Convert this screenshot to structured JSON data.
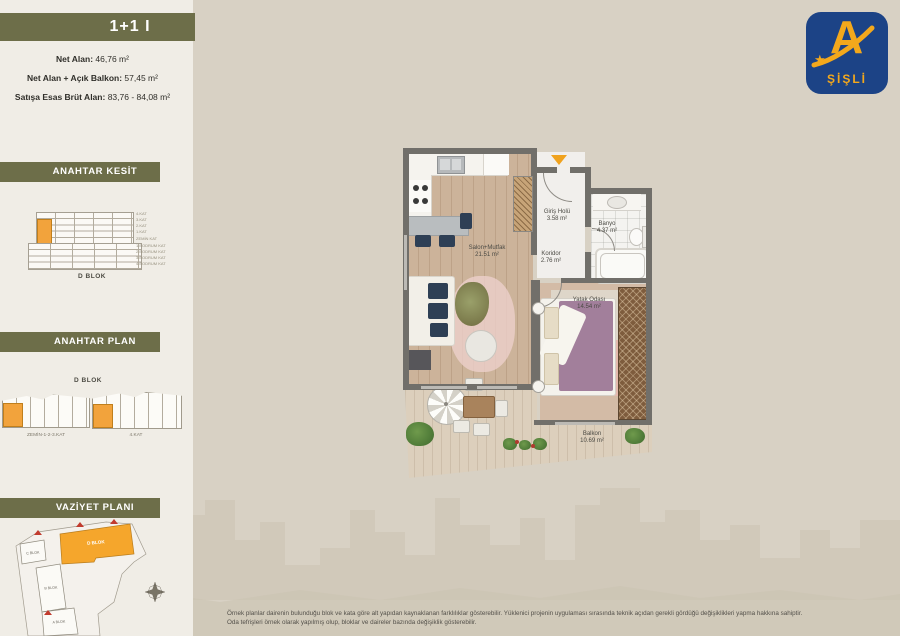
{
  "unit": {
    "title": "1+1 I",
    "areas": [
      {
        "label": "Net Alan:",
        "value": "46,76 m²"
      },
      {
        "label": "Net Alan + Açık Balkon:",
        "value": "57,45 m²"
      },
      {
        "label": "Satışa Esas Brüt Alan:",
        "value": "83,76 - 84,08 m²"
      }
    ]
  },
  "sidebar": {
    "kesit": {
      "title": "ANAHTAR KESİT",
      "caption": "D BLOK",
      "floors": [
        "4.KAT",
        "3.KAT",
        "2.KAT",
        "1.KAT",
        "ZEMİN KAT",
        "1.BODRUM KAT",
        "2.BODRUM KAT",
        "3.BODRUM KAT",
        "4.BODRUM KAT"
      ]
    },
    "plan": {
      "title": "ANAHTAR PLAN",
      "caption": "D BLOK",
      "variants": [
        {
          "label": "ZEMİN-1-2-3.KAT"
        },
        {
          "label": "4.KAT"
        }
      ]
    },
    "vaziyet": {
      "title": "VAZİYET PLANI",
      "blocks": [
        "C BLOK",
        "D BLOK",
        "B BLOK",
        "A BLOK"
      ],
      "highlighted_block": "D BLOK"
    }
  },
  "floorplan": {
    "rooms": [
      {
        "name": "Salon+Mutfak",
        "area": "21.51 m²"
      },
      {
        "name": "Giriş Holü",
        "area": "3.58 m²"
      },
      {
        "name": "Banyo",
        "area": "4.37 m²"
      },
      {
        "name": "Koridor",
        "area": "2.76 m²"
      },
      {
        "name": "Yatak Odası",
        "area": "14.54 m²"
      },
      {
        "name": "Balkon",
        "area": "10.69 m²"
      }
    ]
  },
  "logo": {
    "letter": "A",
    "star": "★",
    "name": "ŞİŞLİ"
  },
  "footer": {
    "line1": "Örnek planlar dairenin bulunduğu blok ve kata göre alt yapıdan kaynaklanan farklılıklar gösterebilir. Yüklenici projenin uygulaması sırasında teknik açıdan gerekli gördüğü değişiklikleri yapma hakkına sahiptir.",
    "line2": "Oda tefrişleri örnek olarak yapılmış olup, bloklar ve daireler bazında değişiklik gösterebilir."
  },
  "colors": {
    "accent_orange": "#F2A33C",
    "olive": "#6D6E49",
    "logo_blue": "#1C4386"
  }
}
